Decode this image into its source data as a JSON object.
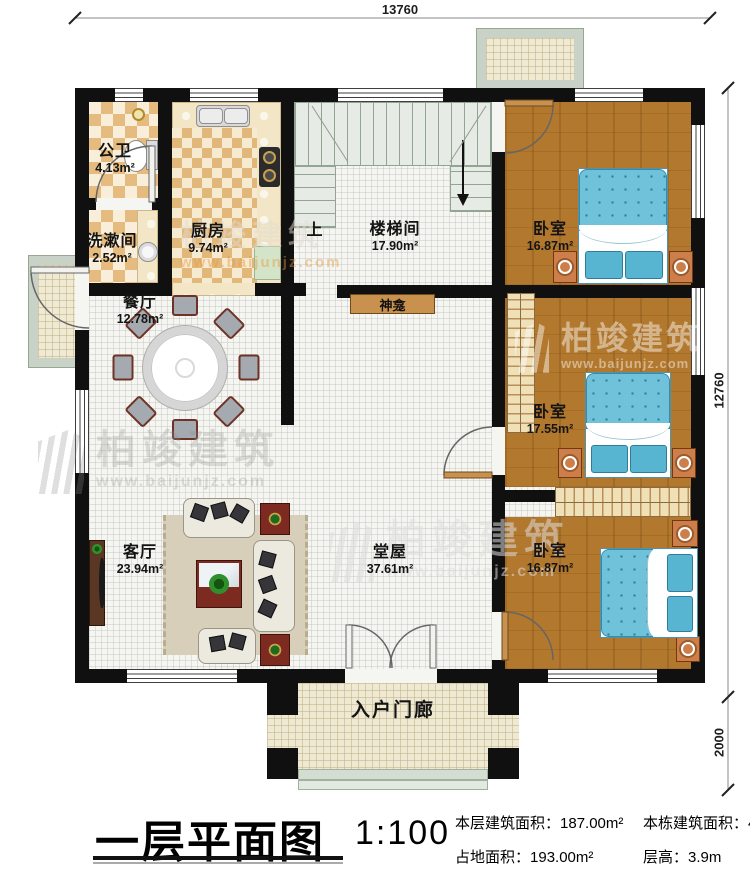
{
  "dims": {
    "top": "13760",
    "right_main": "12760",
    "right_porch": "2000"
  },
  "rooms": {
    "bathroom": {
      "name": "公卫",
      "area": "4.13m²"
    },
    "washroom": {
      "name": "洗漱间",
      "area": "2.52m²"
    },
    "kitchen": {
      "name": "厨房",
      "area": "9.74m²"
    },
    "stairwell": {
      "name": "楼梯间",
      "area": "17.90m²"
    },
    "stairs_up": "上",
    "dining": {
      "name": "餐厅",
      "area": "12.78m²"
    },
    "living": {
      "name": "客厅",
      "area": "23.94m²"
    },
    "hall": {
      "name": "堂屋",
      "area": "37.61m²"
    },
    "shrine": {
      "name": "神龛"
    },
    "porch": {
      "name": "入户门廊"
    },
    "bedroom_top": {
      "name": "卧室",
      "area": "16.87m²"
    },
    "bedroom_mid": {
      "name": "卧室",
      "area": "17.55m²"
    },
    "bedroom_bottom": {
      "name": "卧室",
      "area": "16.87m²"
    }
  },
  "titleblock": {
    "title": "一层平面图",
    "scale": "1:100",
    "stats": [
      {
        "label": "本层建筑面积：",
        "value": "187.00m²"
      },
      {
        "label": "本栋建筑面积：",
        "value": "484.81m²"
      },
      {
        "label": "占地面积：",
        "value": "193.00m²"
      },
      {
        "label": "层高：",
        "value": "3.9m"
      }
    ]
  },
  "watermark": {
    "brand": "柏竣建筑",
    "url": "www.baijunjz.com"
  },
  "colors": {
    "wall": "#101010",
    "wood_floor": "#b2782e",
    "bed_blue": "#6fc2da",
    "tile_tan": "#e5bb80",
    "accent_red": "#7d2a20",
    "landing_green": "#c9d2c6"
  }
}
